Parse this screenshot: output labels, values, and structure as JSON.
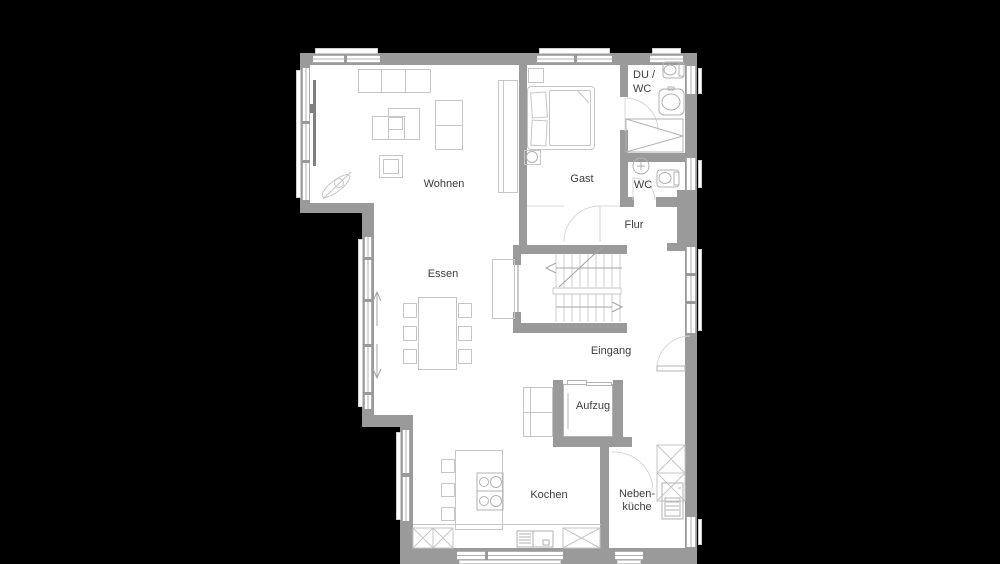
{
  "title": "Grundriss Erdgeschoss",
  "colors": {
    "bg": "#000000",
    "floor": "#ffffff",
    "wall": "#9a9a9a",
    "furn": "#c6c6c6",
    "fix": "#b2b2b2",
    "line": "#c9c9c9",
    "text": "#3c3c3c",
    "dark": "#808080"
  },
  "rooms": {
    "wohnen": {
      "label": "Wohnen"
    },
    "gast": {
      "label": "Gast"
    },
    "du_wc": {
      "label_line1": "DU /",
      "label_line2": "WC"
    },
    "wc": {
      "label": "WC"
    },
    "flur": {
      "label": "Flur"
    },
    "essen": {
      "label": "Essen"
    },
    "eingang": {
      "label": "Eingang"
    },
    "aufzug": {
      "label": "Aufzug"
    },
    "kochen": {
      "label": "Kochen"
    },
    "nebenkueche": {
      "label_line1": "Neben-",
      "label_line2": "küche"
    }
  }
}
